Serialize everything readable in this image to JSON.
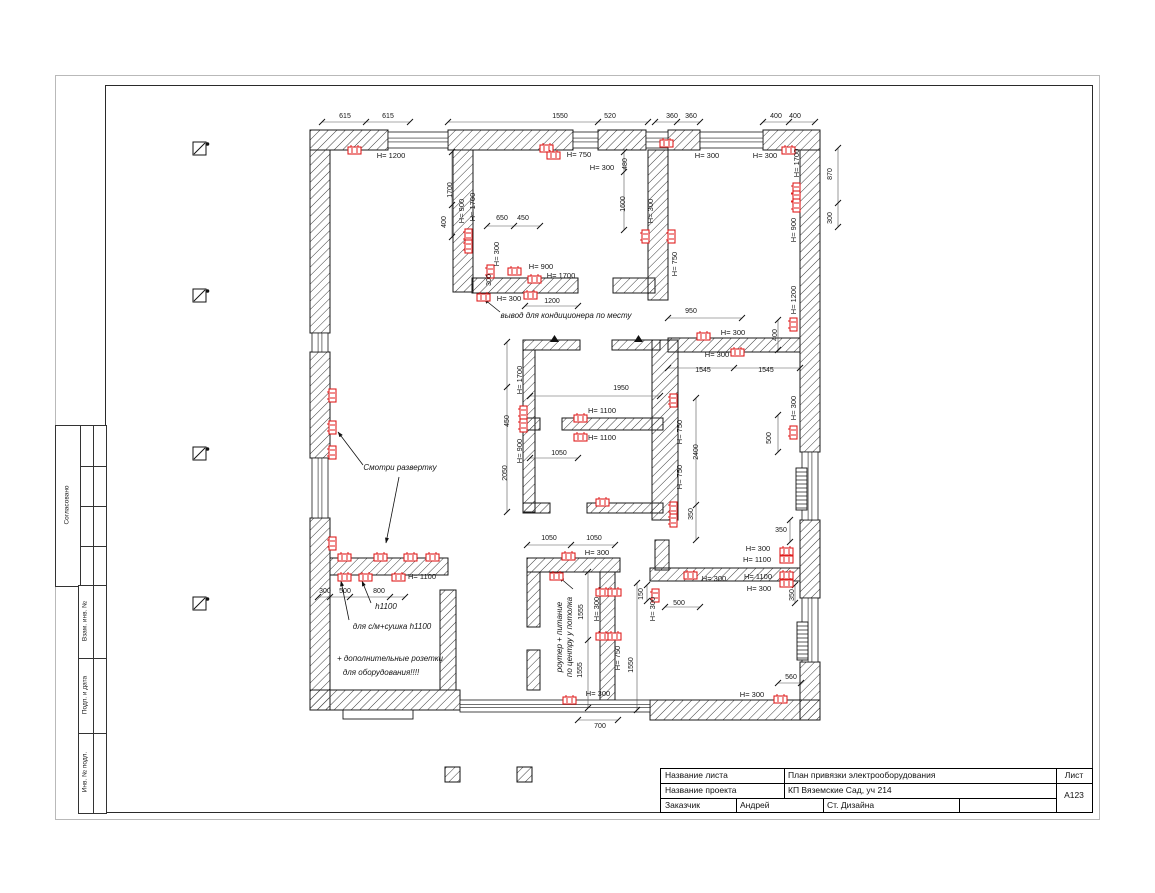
{
  "colors": {
    "outlet": "#e01f1f",
    "wall_line": "#1a1a1a",
    "dim_line": "#555555"
  },
  "stamp": {
    "agreed": "Согласовано",
    "replace_inv": "Взам. инв. №",
    "sign_date": "Подп. и дата",
    "inv_orig": "Инв. № подл."
  },
  "title_block": {
    "sheet_name_label": "Название листа",
    "sheet_name": "План привязки электрооборудования",
    "project_label": "Название проекта",
    "project": "КП Вяземские Сад, уч 214",
    "customer_label": "Заказчик",
    "customer": "Андрей",
    "studio": "Ст. Дизайна",
    "list_label": "Лист",
    "sheet_no": "А123"
  },
  "plan": {
    "walls": [
      [
        310,
        130,
        78,
        20
      ],
      [
        448,
        130,
        125,
        20
      ],
      [
        598,
        130,
        48,
        20
      ],
      [
        668,
        130,
        32,
        20
      ],
      [
        763,
        130,
        57,
        20
      ],
      [
        310,
        150,
        20,
        183
      ],
      [
        310,
        352,
        20,
        106
      ],
      [
        310,
        518,
        20,
        192
      ],
      [
        310,
        690,
        150,
        20
      ],
      [
        650,
        700,
        170,
        20
      ],
      [
        800,
        150,
        20,
        302
      ],
      [
        800,
        520,
        20,
        78
      ],
      [
        800,
        662,
        20,
        58
      ],
      [
        453,
        150,
        20,
        142
      ],
      [
        472,
        278,
        106,
        15
      ],
      [
        613,
        278,
        42,
        15
      ],
      [
        648,
        150,
        20,
        150
      ],
      [
        668,
        338,
        132,
        14
      ],
      [
        655,
        540,
        14,
        30
      ],
      [
        650,
        568,
        150,
        13
      ],
      [
        330,
        558,
        118,
        17
      ],
      [
        440,
        590,
        16,
        100
      ],
      [
        527,
        558,
        93,
        14
      ],
      [
        527,
        572,
        13,
        55
      ],
      [
        527,
        650,
        13,
        40
      ],
      [
        600,
        572,
        15,
        128
      ],
      [
        523,
        340,
        57,
        10
      ],
      [
        612,
        340,
        48,
        10
      ],
      [
        523,
        350,
        12,
        162
      ],
      [
        523,
        418,
        17,
        12
      ],
      [
        562,
        418,
        101,
        12
      ],
      [
        523,
        503,
        27,
        10
      ],
      [
        587,
        503,
        76,
        10
      ],
      [
        652,
        340,
        26,
        180
      ]
    ],
    "windows": [
      [
        388,
        132,
        60,
        16,
        "h"
      ],
      [
        573,
        132,
        25,
        16,
        "h"
      ],
      [
        646,
        132,
        22,
        16,
        "h"
      ],
      [
        700,
        132,
        63,
        16,
        "h"
      ],
      [
        312,
        333,
        16,
        19,
        "v"
      ],
      [
        312,
        458,
        16,
        60,
        "v"
      ],
      [
        802,
        452,
        16,
        68,
        "v"
      ],
      [
        802,
        598,
        16,
        64,
        "v"
      ],
      [
        460,
        700,
        190,
        12,
        "h"
      ]
    ],
    "step": [
      343,
      710,
      70,
      9
    ],
    "outlets": [
      [
        348,
        147,
        "h"
      ],
      [
        540,
        145,
        "h"
      ],
      [
        547,
        152,
        "h"
      ],
      [
        660,
        140,
        "h"
      ],
      [
        782,
        147,
        "h"
      ],
      [
        793,
        183,
        "v"
      ],
      [
        793,
        191,
        "v"
      ],
      [
        793,
        199,
        "v"
      ],
      [
        790,
        318,
        "v"
      ],
      [
        790,
        426,
        "v"
      ],
      [
        780,
        548,
        "h"
      ],
      [
        780,
        556,
        "h"
      ],
      [
        780,
        572,
        "h"
      ],
      [
        780,
        580,
        "h"
      ],
      [
        774,
        696,
        "h"
      ],
      [
        563,
        697,
        "h"
      ],
      [
        329,
        389,
        "v"
      ],
      [
        329,
        421,
        "v"
      ],
      [
        329,
        446,
        "v"
      ],
      [
        329,
        537,
        "v"
      ],
      [
        338,
        554,
        "h"
      ],
      [
        374,
        554,
        "h"
      ],
      [
        404,
        554,
        "h"
      ],
      [
        426,
        554,
        "h"
      ],
      [
        338,
        574,
        "h"
      ],
      [
        359,
        574,
        "h"
      ],
      [
        392,
        574,
        "h"
      ],
      [
        465,
        229,
        "v"
      ],
      [
        465,
        240,
        "v"
      ],
      [
        487,
        265,
        "v"
      ],
      [
        508,
        268,
        "h"
      ],
      [
        528,
        276,
        "h"
      ],
      [
        524,
        292,
        "h"
      ],
      [
        477,
        294,
        "h"
      ],
      [
        642,
        230,
        "v"
      ],
      [
        668,
        230,
        "v"
      ],
      [
        670,
        394,
        "v"
      ],
      [
        520,
        406,
        "v"
      ],
      [
        520,
        419,
        "v"
      ],
      [
        574,
        415,
        "h"
      ],
      [
        574,
        434,
        "h"
      ],
      [
        596,
        499,
        "h"
      ],
      [
        670,
        502,
        "v"
      ],
      [
        670,
        514,
        "v"
      ],
      [
        562,
        553,
        "h"
      ],
      [
        550,
        573,
        "h"
      ],
      [
        596,
        589,
        "h"
      ],
      [
        608,
        589,
        "h"
      ],
      [
        596,
        633,
        "h"
      ],
      [
        608,
        633,
        "h"
      ],
      [
        652,
        589,
        "v"
      ],
      [
        684,
        572,
        "h"
      ],
      [
        731,
        349,
        "h"
      ],
      [
        697,
        333,
        "h"
      ]
    ],
    "labels": [
      [
        "615",
        345,
        118,
        0,
        "d"
      ],
      [
        "615",
        388,
        118,
        0,
        "d"
      ],
      [
        "1550",
        560,
        118,
        0,
        "d"
      ],
      [
        "520",
        610,
        118,
        0,
        "d"
      ],
      [
        "360",
        672,
        118,
        0,
        "d"
      ],
      [
        "360",
        691,
        118,
        0,
        "d"
      ],
      [
        "400",
        776,
        118,
        0,
        "d"
      ],
      [
        "400",
        795,
        118,
        0,
        "d"
      ],
      [
        "H= 1200",
        391,
        158,
        0,
        "h"
      ],
      [
        "H= 750",
        579,
        157,
        0,
        "h"
      ],
      [
        "H= 300",
        602,
        170,
        0,
        "h"
      ],
      [
        "H= 300",
        707,
        158,
        0,
        "h"
      ],
      [
        "H= 300",
        765,
        158,
        0,
        "h"
      ],
      [
        "650",
        502,
        220,
        0,
        "d"
      ],
      [
        "450",
        523,
        220,
        0,
        "d"
      ],
      [
        "H= 900",
        541,
        269,
        0,
        "h"
      ],
      [
        "H= 1700",
        561,
        278,
        0,
        "h"
      ],
      [
        "H= 300",
        509,
        301,
        0,
        "h"
      ],
      [
        "1200",
        552,
        303,
        0,
        "d"
      ],
      [
        "вывод для кондиционера по месту",
        566,
        318,
        0,
        "a"
      ],
      [
        "950",
        691,
        313,
        0,
        "d"
      ],
      [
        "H= 300",
        733,
        335,
        0,
        "h"
      ],
      [
        "H= 300",
        717,
        357,
        0,
        "h"
      ],
      [
        "1545",
        703,
        372,
        0,
        "d"
      ],
      [
        "1545",
        766,
        372,
        0,
        "d"
      ],
      [
        "1950",
        621,
        390,
        0,
        "d"
      ],
      [
        "H= 1100",
        602,
        413,
        0,
        "h"
      ],
      [
        "H= 1100",
        602,
        440,
        0,
        "h"
      ],
      [
        "1050",
        559,
        455,
        0,
        "d"
      ],
      [
        "Смотри развертку",
        400,
        470,
        0,
        "a"
      ],
      [
        "H= 1100",
        422,
        579,
        0,
        "h"
      ],
      [
        "300",
        325,
        593,
        0,
        "d"
      ],
      [
        "500",
        345,
        593,
        0,
        "d"
      ],
      [
        "800",
        379,
        593,
        0,
        "d"
      ],
      [
        "h1100",
        386,
        609,
        0,
        "a"
      ],
      [
        "для с/м+сушка h1100",
        392,
        629,
        0,
        "a"
      ],
      [
        "+ дополнительные розетки",
        390,
        661,
        0,
        "a"
      ],
      [
        "для оборудования!!!!",
        381,
        675,
        0,
        "a"
      ],
      [
        "1050",
        549,
        540,
        0,
        "d"
      ],
      [
        "1050",
        594,
        540,
        0,
        "d"
      ],
      [
        "H= 300",
        597,
        555,
        0,
        "h"
      ],
      [
        "H= 300",
        714,
        581,
        0,
        "h"
      ],
      [
        "H= 300",
        758,
        551,
        0,
        "h"
      ],
      [
        "H= 1100",
        757,
        562,
        0,
        "h"
      ],
      [
        "H= 1100",
        758,
        579,
        0,
        "h"
      ],
      [
        "H= 300",
        759,
        591,
        0,
        "h"
      ],
      [
        "500",
        679,
        605,
        0,
        "d"
      ],
      [
        "350",
        781,
        532,
        0,
        "d"
      ],
      [
        "H= 300",
        598,
        696,
        0,
        "h"
      ],
      [
        "700",
        600,
        728,
        0,
        "d"
      ],
      [
        "560",
        791,
        679,
        0,
        "d"
      ],
      [
        "H= 300",
        752,
        697,
        0,
        "h"
      ],
      [
        "1700",
        452,
        190,
        1,
        "d"
      ],
      [
        "H= 900",
        464,
        211,
        1,
        "h"
      ],
      [
        "H= 1700",
        475,
        207,
        1,
        "h"
      ],
      [
        "400",
        446,
        222,
        1,
        "d"
      ],
      [
        "480",
        627,
        164,
        1,
        "d"
      ],
      [
        "1600",
        625,
        204,
        1,
        "d"
      ],
      [
        "H= 300",
        653,
        211,
        1,
        "h"
      ],
      [
        "H= 750",
        677,
        264,
        1,
        "h"
      ],
      [
        "H= 1700",
        799,
        163,
        1,
        "h"
      ],
      [
        "870",
        832,
        174,
        1,
        "d"
      ],
      [
        "300",
        832,
        218,
        1,
        "d"
      ],
      [
        "H= 900",
        796,
        230,
        1,
        "h"
      ],
      [
        "H= 1200",
        796,
        300,
        1,
        "h"
      ],
      [
        "400",
        777,
        335,
        1,
        "d"
      ],
      [
        "H= 300",
        796,
        408,
        1,
        "h"
      ],
      [
        "500",
        771,
        438,
        1,
        "d"
      ],
      [
        "H= 300",
        499,
        254,
        1,
        "h"
      ],
      [
        "300",
        491,
        280,
        1,
        "d"
      ],
      [
        "H= 1700",
        522,
        380,
        1,
        "h"
      ],
      [
        "450",
        509,
        421,
        1,
        "d"
      ],
      [
        "H= 900",
        522,
        451,
        1,
        "h"
      ],
      [
        "2050",
        507,
        473,
        1,
        "d"
      ],
      [
        "H= 750",
        682,
        432,
        1,
        "h"
      ],
      [
        "H= 750",
        682,
        477,
        1,
        "h"
      ],
      [
        "2400",
        698,
        452,
        1,
        "d"
      ],
      [
        "350",
        693,
        514,
        1,
        "d"
      ],
      [
        "1555",
        583,
        612,
        1,
        "d"
      ],
      [
        "1555",
        582,
        670,
        1,
        "d"
      ],
      [
        "H= 300",
        599,
        609,
        1,
        "h"
      ],
      [
        "H= 750",
        620,
        658,
        1,
        "h"
      ],
      [
        "1550",
        633,
        665,
        1,
        "d"
      ],
      [
        "H= 300",
        655,
        609,
        1,
        "h"
      ],
      [
        "150",
        643,
        594,
        1,
        "d"
      ],
      [
        "350",
        794,
        595,
        1,
        "d"
      ],
      [
        "роутер + питание",
        562,
        637,
        1,
        "a"
      ],
      [
        "по центру у потолка",
        572,
        637,
        1,
        "a"
      ]
    ],
    "dims": [
      [
        322,
        122,
        410,
        122
      ],
      [
        448,
        122,
        648,
        122
      ],
      [
        655,
        122,
        700,
        122
      ],
      [
        763,
        122,
        815,
        122
      ],
      [
        452,
        152,
        452,
        237
      ],
      [
        487,
        226,
        540,
        226
      ],
      [
        624,
        152,
        624,
        230
      ],
      [
        668,
        318,
        742,
        318
      ],
      [
        668,
        368,
        800,
        368
      ],
      [
        530,
        396,
        660,
        396
      ],
      [
        530,
        458,
        578,
        458
      ],
      [
        507,
        342,
        507,
        512
      ],
      [
        696,
        398,
        696,
        540
      ],
      [
        778,
        415,
        778,
        452
      ],
      [
        838,
        148,
        838,
        227
      ],
      [
        778,
        320,
        778,
        350
      ],
      [
        318,
        597,
        405,
        597
      ],
      [
        527,
        545,
        615,
        545
      ],
      [
        588,
        572,
        588,
        708
      ],
      [
        637,
        583,
        637,
        710
      ],
      [
        578,
        720,
        618,
        720
      ],
      [
        778,
        683,
        801,
        683
      ],
      [
        665,
        607,
        700,
        607
      ],
      [
        647,
        585,
        647,
        601
      ],
      [
        795,
        585,
        795,
        603
      ],
      [
        525,
        306,
        578,
        306
      ],
      [
        790,
        520,
        790,
        542
      ]
    ],
    "ticks": [
      [
        322,
        122
      ],
      [
        366,
        122
      ],
      [
        410,
        122
      ],
      [
        448,
        122
      ],
      [
        598,
        122
      ],
      [
        648,
        122
      ],
      [
        655,
        122
      ],
      [
        677,
        122
      ],
      [
        700,
        122
      ],
      [
        763,
        122
      ],
      [
        789,
        122
      ],
      [
        815,
        122
      ],
      [
        452,
        152
      ],
      [
        452,
        205
      ],
      [
        452,
        237
      ],
      [
        487,
        226
      ],
      [
        514,
        226
      ],
      [
        540,
        226
      ],
      [
        624,
        152
      ],
      [
        624,
        172
      ],
      [
        624,
        230
      ],
      [
        668,
        318
      ],
      [
        742,
        318
      ],
      [
        668,
        368
      ],
      [
        734,
        368
      ],
      [
        800,
        368
      ],
      [
        530,
        396
      ],
      [
        660,
        396
      ],
      [
        530,
        458
      ],
      [
        578,
        458
      ],
      [
        507,
        342
      ],
      [
        507,
        387
      ],
      [
        507,
        512
      ],
      [
        696,
        398
      ],
      [
        696,
        505
      ],
      [
        696,
        540
      ],
      [
        778,
        415
      ],
      [
        778,
        452
      ],
      [
        838,
        148
      ],
      [
        838,
        203
      ],
      [
        838,
        227
      ],
      [
        778,
        320
      ],
      [
        778,
        350
      ],
      [
        318,
        597
      ],
      [
        330,
        597
      ],
      [
        350,
        597
      ],
      [
        390,
        597
      ],
      [
        405,
        597
      ],
      [
        527,
        545
      ],
      [
        571,
        545
      ],
      [
        615,
        545
      ],
      [
        588,
        572
      ],
      [
        588,
        640
      ],
      [
        588,
        708
      ],
      [
        637,
        583
      ],
      [
        637,
        710
      ],
      [
        578,
        720
      ],
      [
        618,
        720
      ],
      [
        778,
        683
      ],
      [
        801,
        683
      ],
      [
        665,
        607
      ],
      [
        700,
        607
      ],
      [
        647,
        585
      ],
      [
        647,
        601
      ],
      [
        795,
        585
      ],
      [
        795,
        603
      ],
      [
        525,
        306
      ],
      [
        578,
        306
      ],
      [
        790,
        520
      ],
      [
        790,
        542
      ]
    ],
    "leaders": [
      [
        399,
        477,
        386,
        543
      ],
      [
        363,
        465,
        338,
        432
      ],
      [
        500,
        312,
        484,
        299
      ],
      [
        573,
        589,
        559,
        577
      ],
      [
        349,
        620,
        341,
        581
      ],
      [
        371,
        603,
        362,
        581
      ]
    ],
    "ladders": [
      [
        796,
        468,
        11,
        42
      ],
      [
        797,
        622,
        11,
        38
      ]
    ],
    "markers": [
      [
        193,
        142
      ],
      [
        193,
        289
      ],
      [
        193,
        447
      ],
      [
        193,
        597
      ]
    ],
    "legend": [
      [
        445,
        767
      ],
      [
        517,
        767
      ]
    ],
    "triangles": [
      [
        550,
        335
      ],
      [
        634,
        335
      ],
      [
        552,
        572
      ]
    ]
  }
}
